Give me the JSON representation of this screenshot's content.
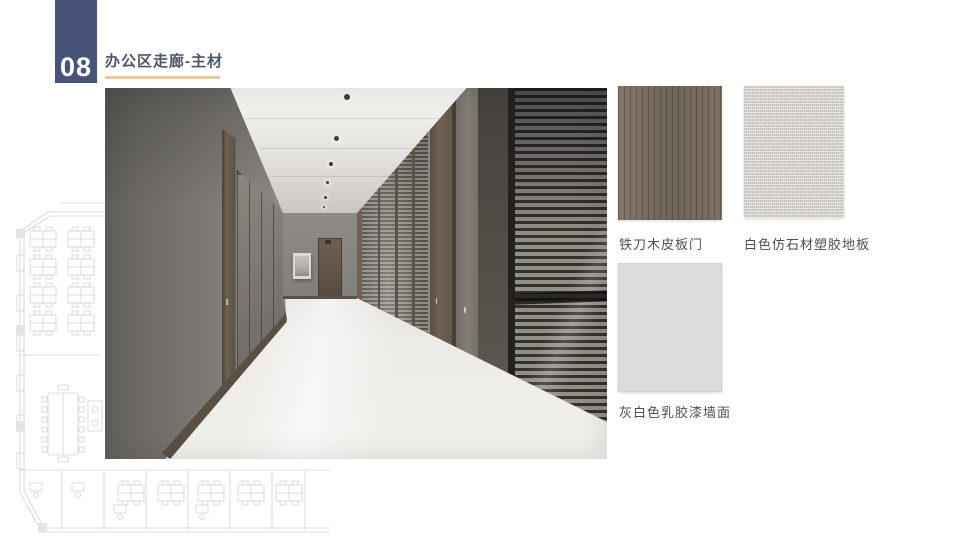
{
  "slide": {
    "page_number": "08",
    "title": "办公区走廊-主材"
  },
  "materials": [
    {
      "id": "wood-veneer-door",
      "name": "铁刀木皮板门"
    },
    {
      "id": "white-stone-look-vinyl-floor",
      "name": "白色仿石材塑胶地板"
    },
    {
      "id": "gray-white-latex-paint-wall",
      "name": "灰白色乳胶漆墙面"
    }
  ],
  "photo": {
    "description": "office corridor rendering",
    "elements": [
      "gray fabric left wall",
      "white vinyl floor",
      "recessed ceiling downlights",
      "wood veneer doors",
      "glass partitions with venetian blinds",
      "end wall door",
      "framed artwork"
    ]
  },
  "background": {
    "watermark": "office floor plan line drawing"
  },
  "colors": {
    "page_tab": "#475377",
    "title_text": "#4e5566",
    "title_underline": "#e9c99c",
    "label_text": "#4f4f4f",
    "wood_swatch": "#7b7065",
    "stone_swatch": "#dbd8d3",
    "paint_swatch": "#dcdcdb"
  }
}
